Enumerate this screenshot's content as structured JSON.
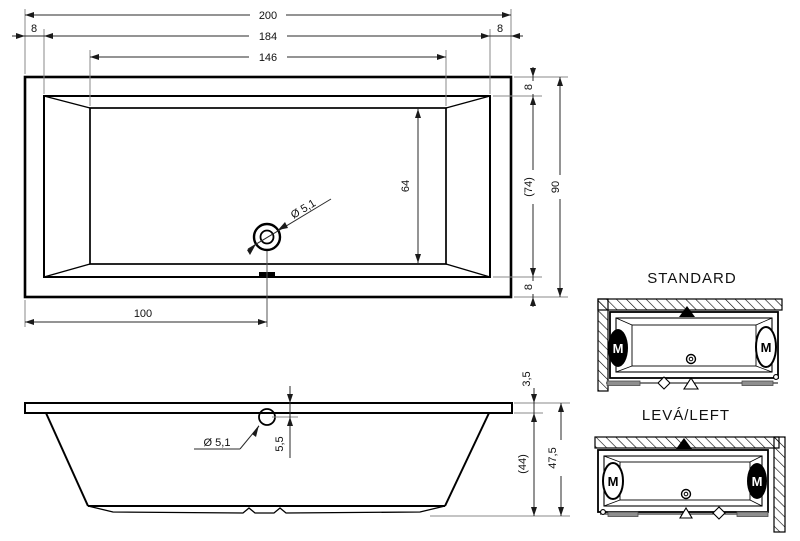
{
  "top_view": {
    "dim_overall_width": "200",
    "dim_rim_left": "8",
    "dim_inner_width": "184",
    "dim_rim_right": "8",
    "dim_floor_width": "146",
    "dim_rim_top": "8",
    "dim_inner_depth": "(74)",
    "dim_overall_depth": "90",
    "dim_rim_bottom": "8",
    "dim_floor_depth": "64",
    "dim_drain_offset": "100",
    "label_drain_diameter": "Ø 5,1"
  },
  "front_view": {
    "dim_rim_thickness": "3,5",
    "dim_drain_drop": "5,5",
    "dim_shell_height": "(44)",
    "dim_total_height": "47,5",
    "label_drain_diameter": "Ø 5,1"
  },
  "variants": {
    "standard": {
      "title": "STANDARD",
      "motor_left": "M",
      "motor_right": "M"
    },
    "left": {
      "title": "LEVÁ/LEFT",
      "motor_left": "M",
      "motor_right": "M"
    }
  },
  "colors": {
    "line": "#000000",
    "extension_line": "#8a8a8a",
    "foot_bar": "#8f8f8f"
  }
}
